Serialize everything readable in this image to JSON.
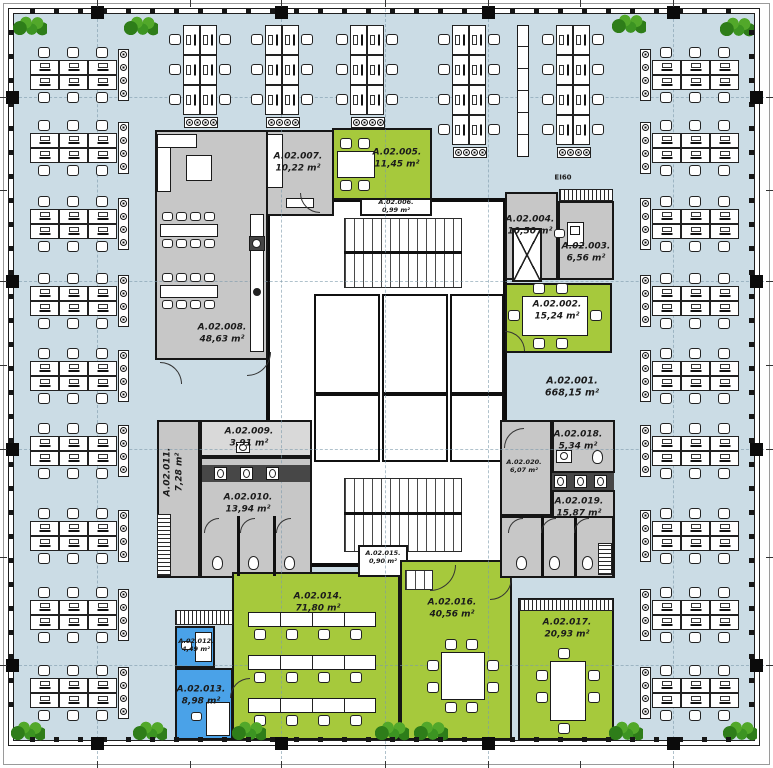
{
  "plan": {
    "type": "architectural-floor-plan",
    "fire_rating_label": "EI60",
    "open_area": {
      "name": "A.02.001.",
      "area": "668,15 m²",
      "fill": "open-blue"
    },
    "rooms": [
      {
        "name": "A.02.002.",
        "area": "15,24 m²",
        "fill": "green"
      },
      {
        "name": "A.02.003.",
        "area": "6,56 m²",
        "fill": "gray"
      },
      {
        "name": "A.02.004.",
        "area": "10,50 m²",
        "fill": "gray"
      },
      {
        "name": "A.02.005.",
        "area": "11,45 m²",
        "fill": "green"
      },
      {
        "name": "A.02.006.",
        "area": "0,99 m²",
        "fill": "white"
      },
      {
        "name": "A.02.007.",
        "area": "10,22 m²",
        "fill": "gray"
      },
      {
        "name": "A.02.008.",
        "area": "48,63 m²",
        "fill": "gray"
      },
      {
        "name": "A.02.009.",
        "area": "3,91 m²",
        "fill": "light-gray"
      },
      {
        "name": "A.02.010.",
        "area": "13,94 m²",
        "fill": "gray"
      },
      {
        "name": "A.02.011.",
        "area": "7,28 m²",
        "fill": "gray"
      },
      {
        "name": "A.02.012.",
        "area": "4,49 m²",
        "fill": "blue"
      },
      {
        "name": "A.02.013.",
        "area": "8,98 m²",
        "fill": "blue"
      },
      {
        "name": "A.02.014.",
        "area": "71,80 m²",
        "fill": "green"
      },
      {
        "name": "A.02.015.",
        "area": "0,90 m²",
        "fill": "white"
      },
      {
        "name": "A.02.016.",
        "area": "40,56 m²",
        "fill": "green"
      },
      {
        "name": "A.02.017.",
        "area": "20,93 m²",
        "fill": "green"
      },
      {
        "name": "A.02.018.",
        "area": "5,34 m²",
        "fill": "gray"
      },
      {
        "name": "A.02.019.",
        "area": "15,87 m²",
        "fill": "gray"
      },
      {
        "name": "A.02.020.",
        "area": "6,07 m²",
        "fill": "gray"
      }
    ],
    "colors": {
      "open_space": "#cbdce5",
      "meeting_green": "#a6c93c",
      "service_gray": "#c7c7c7",
      "service_gray_light": "#d9d9d9",
      "office_blue": "#4aa2e8",
      "room_white": "#ffffff",
      "wall_black": "#111111",
      "plant_green": "#4a9e28"
    }
  }
}
